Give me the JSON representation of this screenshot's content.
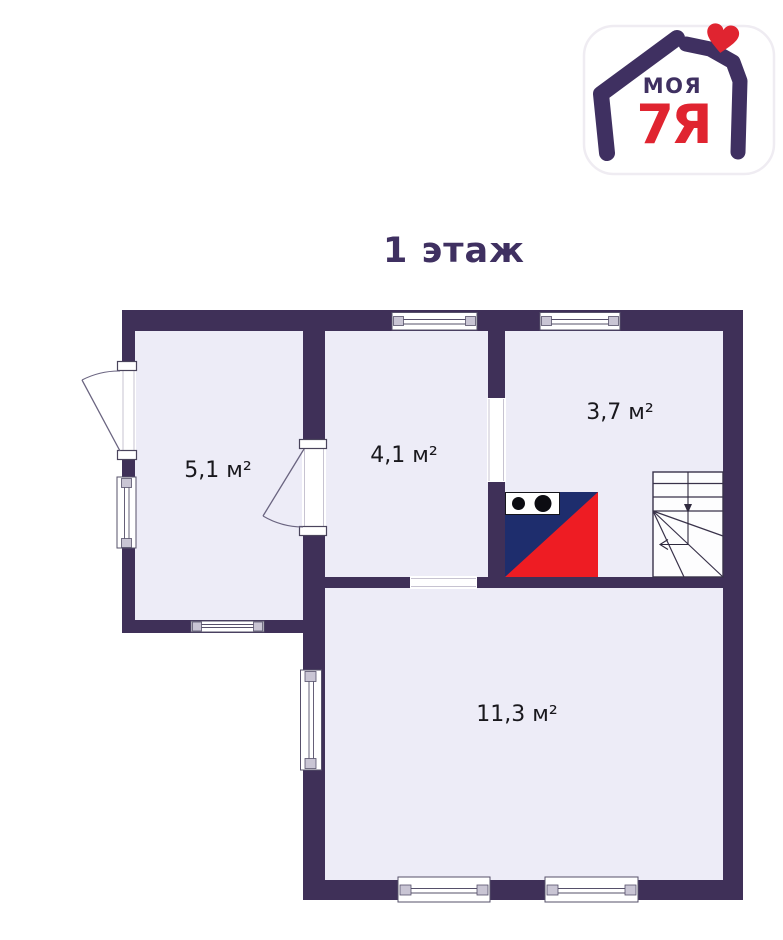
{
  "title": "1 этаж",
  "logo": {
    "text_top": "МОЯ",
    "text_bottom": "7Я"
  },
  "rooms": [
    {
      "id": "room-1",
      "area": "5,1 м²"
    },
    {
      "id": "room-2",
      "area": "4,1 м²"
    },
    {
      "id": "room-3",
      "area": "3,7 м²"
    },
    {
      "id": "room-4",
      "area": "11,3 м²"
    }
  ],
  "icons": {
    "stove": "stove-icon",
    "stairs": "stairs-icon",
    "heart": "heart-icon",
    "house": "house-icon"
  },
  "colors": {
    "background": "#ffffff",
    "wall": "#3f3058",
    "floor": "#edecf7",
    "accent_purple": "#3f3061",
    "accent_red": "#e02430",
    "stove_blue": "#1e2d6d",
    "stove_red": "#ee1c23",
    "label_text": "#19181d"
  }
}
